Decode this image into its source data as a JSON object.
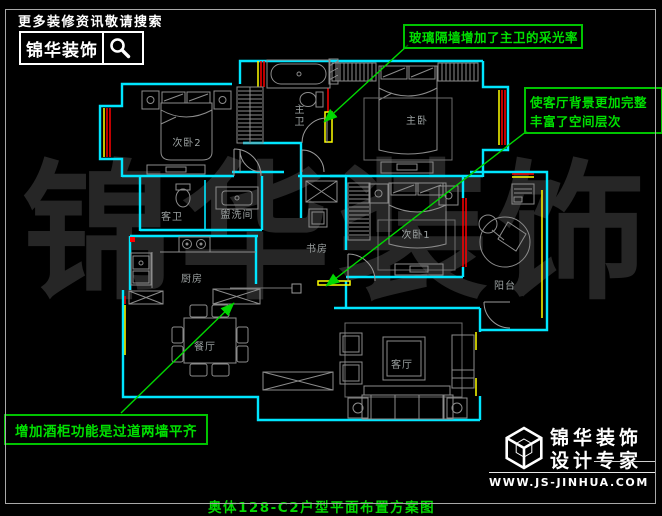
{
  "header": {
    "tagline": "更多装修资讯敬请搜索",
    "brand": "锦华装饰",
    "search_icon": "magnifier"
  },
  "watermark": "锦华装饰",
  "plan": {
    "rooms": {
      "bedroom2": "次卧2",
      "master_bath": "主卫",
      "master_bedroom": "主卧",
      "guest_bath": "客卫",
      "washroom": "盥洗间",
      "study": "书房",
      "bedroom1": "次卧1",
      "kitchen": "厨房",
      "dining": "餐厅",
      "living": "客厅",
      "balcony": "阳台"
    },
    "colors": {
      "wall": "#00ffff",
      "furniture": "#8c8c8c",
      "window_red": "#ff0000",
      "window_yellow": "#ffff00",
      "annotation_green": "#00d800",
      "label_gray": "#9aa0a0"
    }
  },
  "annotations": {
    "glass": {
      "text": "玻璃隔墙增加了主卫的采光率"
    },
    "background": {
      "line1": "使客厅背景更加完整",
      "line2": "丰富了空间层次"
    },
    "cabinet": {
      "text": "增加酒柜功能是过道两墙平齐"
    }
  },
  "footer": {
    "brand": "锦华装饰",
    "slogan": "设计专家",
    "website": "WWW.JS-JINHUA.COM",
    "logo_icon": "cube-wireframe"
  },
  "title": "奥体128-C2户型平面布置方案图"
}
